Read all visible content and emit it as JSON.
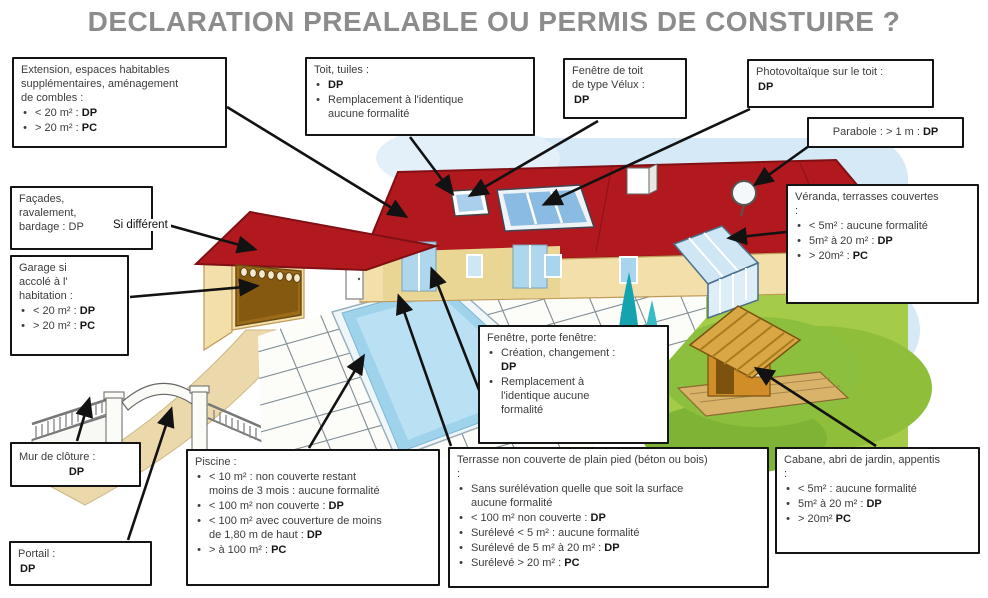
{
  "title": "DECLARATION PREALABLE OU PERMIS DE CONSTUIRE ?",
  "labels": {
    "si_different": "Si différent"
  },
  "palette": {
    "title_gray": "#8c8c8c",
    "roof_red": "#b2191f",
    "wall_cream": "#f2dfa9",
    "pool_blue": "#9fd3ec",
    "grass_green": "#a5cc49",
    "sky_blue": "#d5e9f6",
    "box_border": "#141414",
    "dp_pc_text": "#161616"
  },
  "callouts": {
    "extension": {
      "lead": "Extension, espaces habitables\nsupplémentaires,  aménagement\nde combles :",
      "items": [
        "< 20 m² : **DP**",
        "> 20 m² : **PC**"
      ]
    },
    "toit": {
      "lead": "Toit, tuiles :",
      "items": [
        "**DP**",
        "Remplacement  à l'identique\naucune formalité"
      ]
    },
    "velux": {
      "lead": "Fenêtre de toit\nde type Vélux :",
      "bullets": false,
      "items": [
        "**DP**"
      ]
    },
    "photovoltaique": {
      "lead": "Photovoltaïque  sur le toit :",
      "bullets": false,
      "items": [
        "**DP**"
      ]
    },
    "parabole": {
      "lead": "Parabole : > 1 m : **DP**",
      "items": []
    },
    "facades": {
      "lead": "Façades,\nravalement,\nbardage : DP",
      "items": []
    },
    "garage": {
      "lead": "Garage si\naccolé à l'\nhabitation :",
      "items": [
        "< 20 m² : **DP**",
        "> 20 m² : **PC**"
      ]
    },
    "veranda": {
      "lead": "Véranda, terrasses couvertes\n:",
      "items": [
        "< 5m² : aucune formalité",
        "5m² à 20 m² : **DP**",
        "> 20m² : **PC**"
      ]
    },
    "fenetre": {
      "lead": "Fenêtre, porte fenêtre:",
      "items": [
        "Création, changement :\n**DP**",
        "Remplacement à\nl'identique  aucune\nformalité"
      ]
    },
    "mur": {
      "lead": "Mur de clôture  :",
      "bullets": false,
      "items": [
        "**DP**"
      ]
    },
    "portail": {
      "lead": "Portail :",
      "bullets": false,
      "items": [
        "**DP**"
      ]
    },
    "piscine": {
      "lead": "Piscine :",
      "items": [
        "< 10 m² : non couverte restant\nmoins de 3 mois : aucune formalité",
        "< 100 m²  non couverte : **DP**",
        "< 100 m² avec couverture  de moins\nde 1,80 m de haut : **DP**",
        "> à 100 m² : **PC**"
      ]
    },
    "terrasse": {
      "lead": "Terrasse non couverte  de plain pied (béton ou bois)\n:",
      "items": [
        "Sans surélévation  quelle que soit la surface\naucune formalité",
        "< 100 m²  non couverte : **DP**",
        "Surélevé  < 5 m² : aucune formalité",
        "Surélevé de 5 m² à 20 m² : **DP**",
        "Surélevé > 20 m² : **PC**"
      ]
    },
    "cabane": {
      "lead": "Cabane, abri de jardin, appentis\n:",
      "items": [
        "< 5m² : aucune formalité",
        "5m² à 20 m² : **DP**",
        "> 20m² **PC**"
      ]
    }
  }
}
